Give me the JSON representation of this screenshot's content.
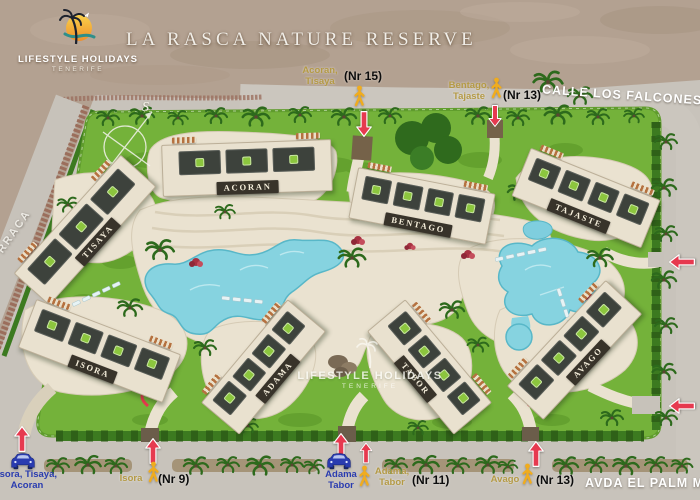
{
  "title": "LA RASCA NATURE RESERVE",
  "logo": {
    "name": "LIFESTYLE HOLIDAYS",
    "subname": "TENERIFE"
  },
  "watermark": {
    "name": "LIFESTYLE HOLIDAYS",
    "subname": "TENERIFE"
  },
  "compass": {
    "label": "S"
  },
  "streets": {
    "top": "CALLE LOS FALCONES",
    "bottom": "AVDA EL PALM MAR",
    "left": "RRACA"
  },
  "buildings": [
    {
      "name": "ACORAN"
    },
    {
      "name": "TISAYA"
    },
    {
      "name": "BENTAGO"
    },
    {
      "name": "TAJASTE"
    },
    {
      "name": "ISORA"
    },
    {
      "name": "ADAMA"
    },
    {
      "name": "TABOR"
    },
    {
      "name": "AVAGO"
    }
  ],
  "entrances": {
    "top_ped_acoran": {
      "type": "pedestrian",
      "destinations": "Acoran, Tisaya",
      "number": "(Nr 15)"
    },
    "top_ped_bentago": {
      "type": "pedestrian",
      "destinations": "Bentago, Tajaste",
      "number": "(Nr 13)"
    },
    "bottom_car_isora": {
      "type": "car",
      "destinations": "Isora, Tisaya, Acoran"
    },
    "bottom_ped_isora": {
      "type": "pedestrian",
      "destinations": "Isora",
      "number": "(Nr 9)"
    },
    "bottom_car_adama": {
      "type": "car",
      "destinations": "Adama Tabor"
    },
    "bottom_ped_adama": {
      "type": "pedestrian",
      "destinations": "Adama, Tabor",
      "number": "(Nr 11)"
    },
    "bottom_ped_avago": {
      "type": "pedestrian",
      "destinations": "Avago",
      "number": "(Nr 13)"
    }
  },
  "icons": {
    "pedestrian": "yellow walking-person pictogram",
    "car": "blue car front pictogram",
    "entrance_arrow": "red arrow with white outline",
    "compass": "compass rose with S",
    "palm": "palm-tree glyph"
  },
  "colors": {
    "arrow_red": "#e6394f",
    "pedestrian_yellow": "#f0ac1e",
    "car_blue": "#2a3cb0",
    "lawn_green": "#74b23a",
    "pool_turquoise": "#86d3e0",
    "path_cream": "#eae2d0",
    "plaque_brown": "#38332a",
    "roof_dark": "#3d423c",
    "logo_green": "#8cc63e",
    "label_tan": "#b49a45",
    "beach_sand": "#b3a191",
    "road_grey": "#c8c3bb"
  }
}
